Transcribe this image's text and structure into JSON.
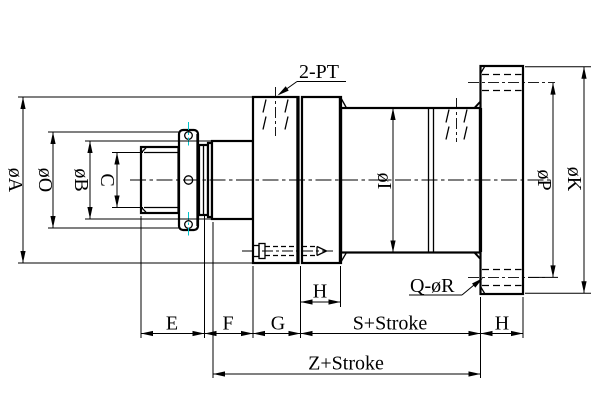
{
  "drawing": {
    "labels": {
      "dia_A": "øA",
      "dia_O": "øO",
      "dia_B": "øB",
      "C": "C",
      "dia_I": "øI",
      "dia_P": "øP",
      "dia_K": "øK",
      "E": "E",
      "F": "F",
      "G": "G",
      "H_port_block": "H",
      "S_stroke": "S+Stroke",
      "H_flange": "H",
      "Z_stroke": "Z+Stroke",
      "ports_callout": "2-PT",
      "bolt_holes_callout": "Q-øR"
    },
    "colors": {
      "line": "#000000",
      "background": "#ffffff",
      "center_mark": "#00c4cc"
    }
  }
}
